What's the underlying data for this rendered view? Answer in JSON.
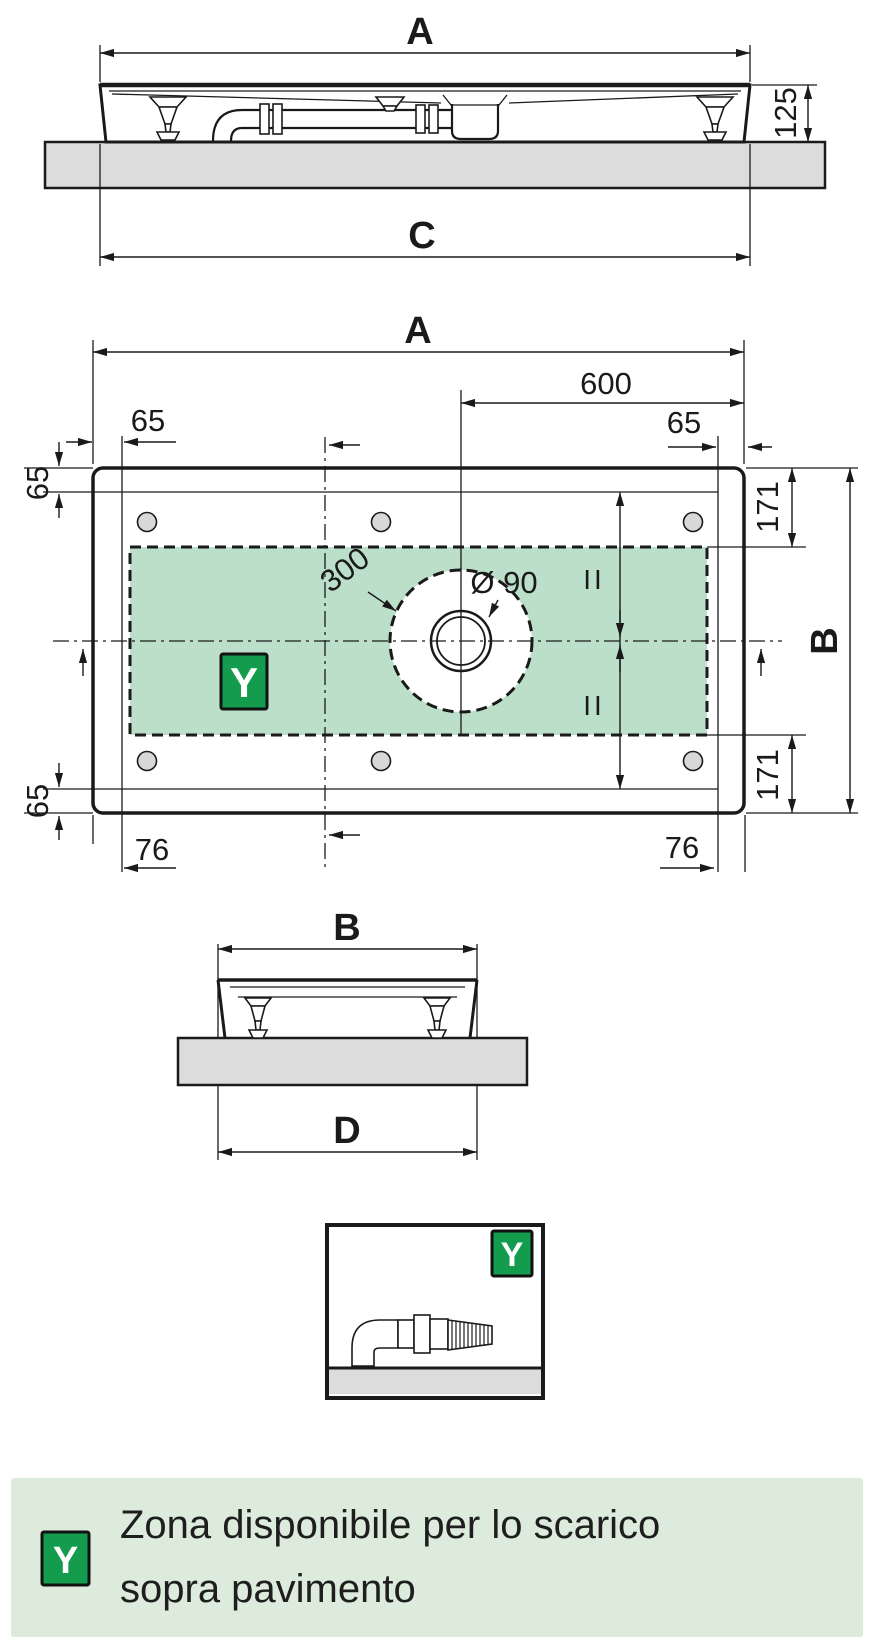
{
  "colors": {
    "line": "#1a1a1a",
    "floor_gray": "#dcdcdc",
    "zone_green": "#bcdfca",
    "badge_green": "#149c4e",
    "legend_bg": "#dcebdc"
  },
  "front_view": {
    "dim_width_top": "A",
    "dim_height": "125",
    "dim_width_bottom": "C"
  },
  "plan_view": {
    "dim_width_top": "A",
    "dim_drain_to_edge": "600",
    "dim_inset_top_left": "65",
    "dim_inset_top_right": "65",
    "dim_inset_left_upper": "65",
    "dim_inset_left_lower": "65",
    "dim_zone_right_upper": "171",
    "dim_zone_right_lower": "171",
    "dim_depth": "B",
    "dim_inset_bottom_left": "76",
    "dim_inset_bottom_right": "76",
    "service_circle_diameter": "300",
    "drain_diameter": "Ø 90",
    "equal_upper": "II",
    "equal_lower": "II",
    "zone_badge": "Y"
  },
  "side_view": {
    "dim_width_top": "B",
    "dim_width_bottom": "D"
  },
  "detail_view": {
    "zone_badge": "Y"
  },
  "legend": {
    "badge": "Y",
    "line1": "Zona disponibile per lo scarico",
    "line2": "sopra pavimento"
  }
}
